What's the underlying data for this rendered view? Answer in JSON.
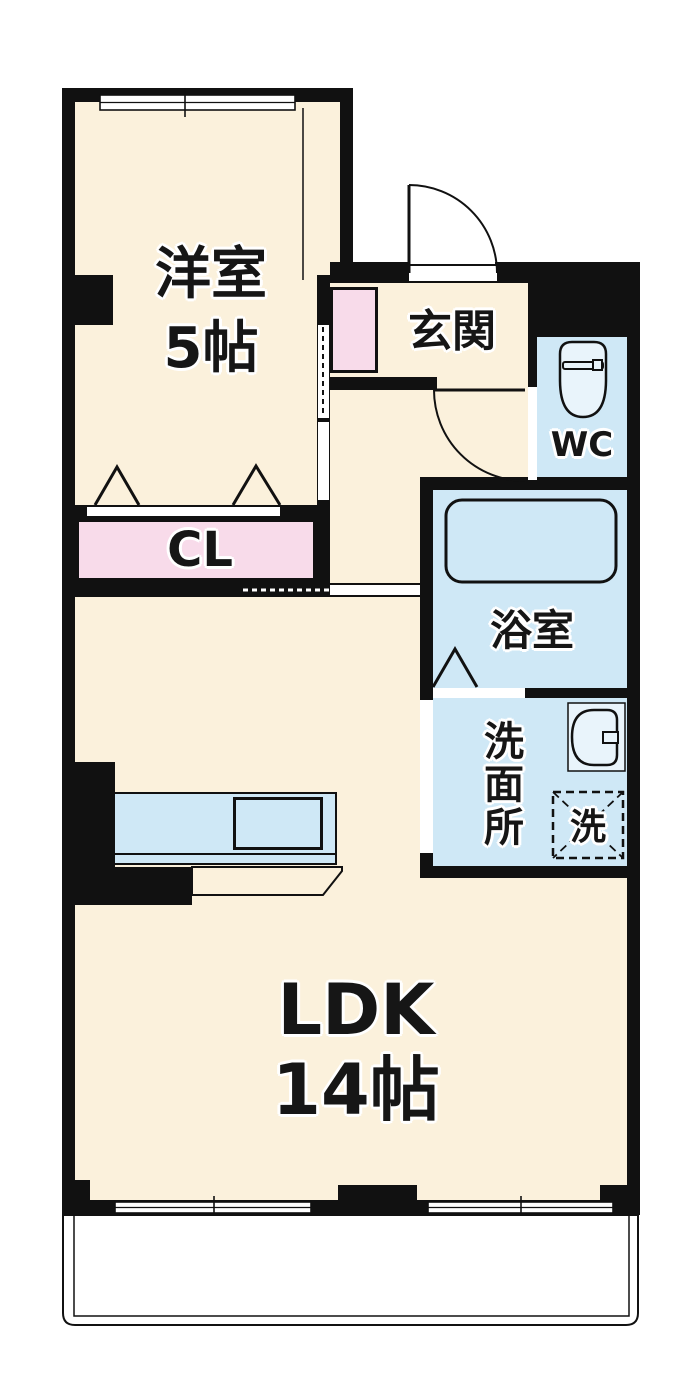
{
  "plan": {
    "title": "1LDK floor plan",
    "rooms": {
      "yoshitsu": {
        "name": "洋室",
        "size": "5帖"
      },
      "genkan": {
        "name": "玄関"
      },
      "wc": {
        "name": "WC"
      },
      "closet": {
        "name": "CL"
      },
      "bath": {
        "name": "浴室"
      },
      "senmenjo": {
        "name": "洗面所"
      },
      "laundry": {
        "name": "洗"
      },
      "ldk": {
        "name": "LDK",
        "size": "14帖"
      }
    },
    "colors": {
      "cream": "#FBF1DC",
      "pink": "#F8DBEA",
      "blue": "#CFE8F6",
      "fixture": "#E9F4FB",
      "wall": "#111111"
    }
  }
}
